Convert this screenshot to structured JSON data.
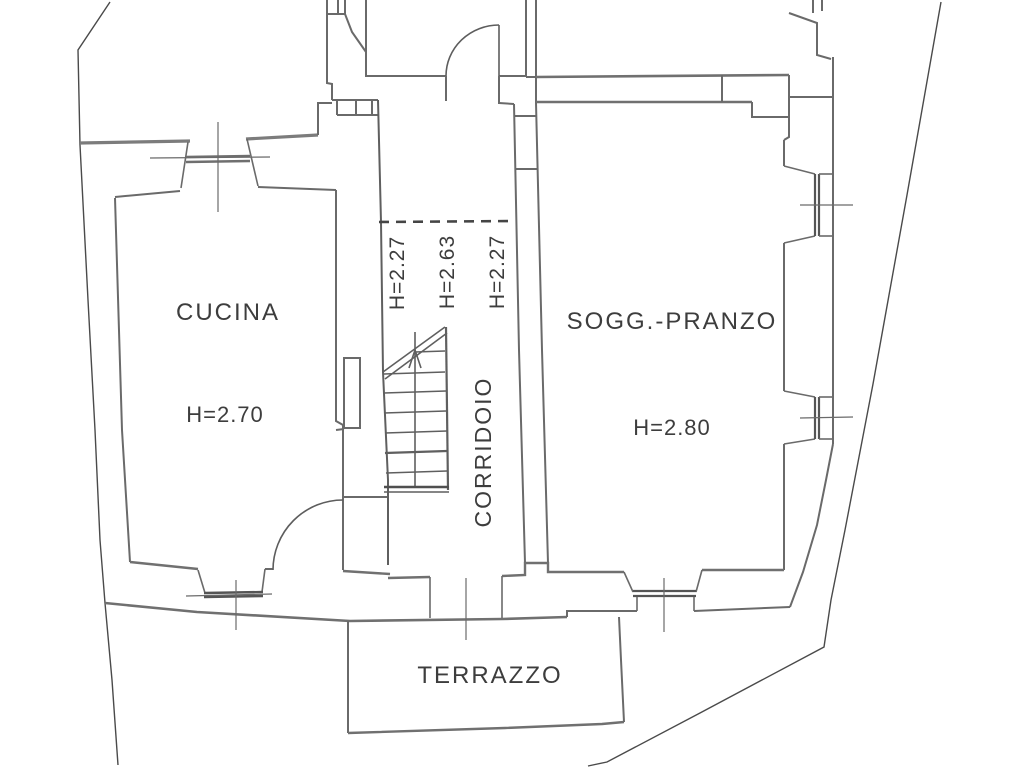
{
  "document": {
    "type": "architectural floor plan",
    "background_color": "#ffffff",
    "wall_color": "#6a6a6a",
    "text_color": "#3d3d3d"
  },
  "rooms": [
    {
      "id": "cucina",
      "label": "CUCINA",
      "height": "H=2.70"
    },
    {
      "id": "sogg-pranzo",
      "label": "SOGG.-PRANZO",
      "height": "H=2.80"
    },
    {
      "id": "corridoio",
      "label": "CORRIDOIO",
      "heights": [
        "H=2.27",
        "H=2.63",
        "H=2.27"
      ]
    },
    {
      "id": "terrazzo",
      "label": "TERRAZZO"
    }
  ]
}
